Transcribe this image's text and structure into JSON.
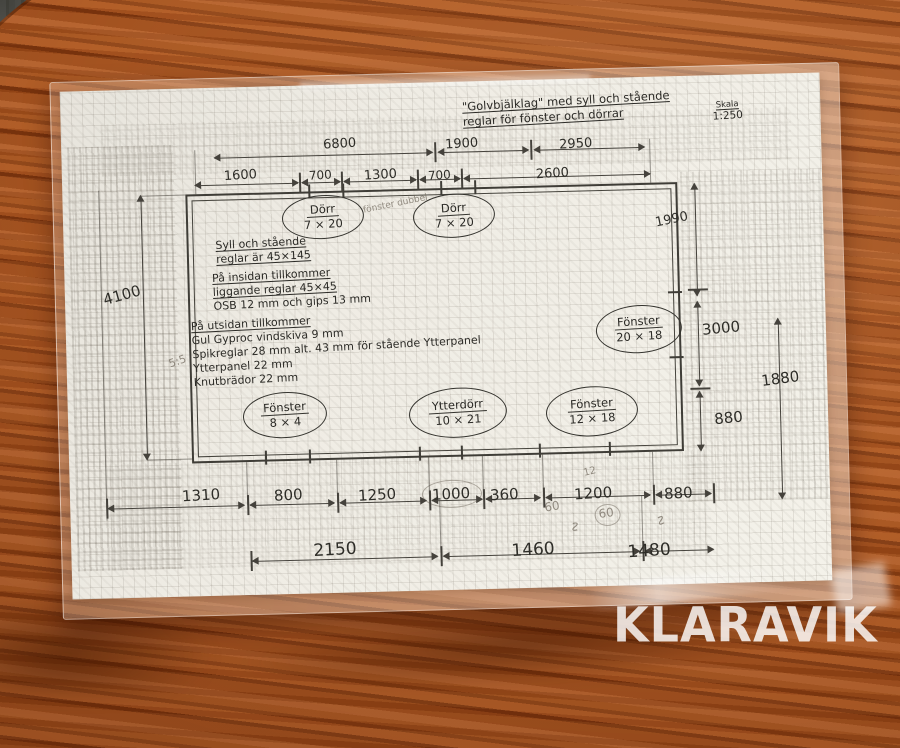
{
  "scene": {
    "watermark": "KLARAVIK"
  },
  "drawing": {
    "title_line1": "\"Golvbjälklag\" med syll och stående",
    "title_line2": "reglar för fönster och dörrar",
    "scale_label": "Skala",
    "scale_value": "1:250",
    "notes_sill": [
      "Syll och stående",
      "reglar är 45×145"
    ],
    "notes_inside": [
      "På insidan tillkommer",
      "liggande reglar 45×45",
      "OSB 12 mm och gips 13 mm"
    ],
    "notes_outside": [
      "På utsidan tillkommer",
      "Gul Gyproc vindskiva 9 mm",
      "Spikreglar 28 mm alt. 43 mm för stående Ytterpanel",
      "Ytterpanel 22 mm",
      "Knutbrädor 22 mm"
    ],
    "openings": [
      {
        "label": "Dörr",
        "size": "7 × 20"
      },
      {
        "label": "Dörr",
        "size": "7 × 20"
      },
      {
        "label": "Fönster",
        "size": "20 × 18"
      },
      {
        "label": "Fönster",
        "size": "8 × 4"
      },
      {
        "label": "Ytterdörr",
        "size": "10 × 21"
      },
      {
        "label": "Fönster",
        "size": "12 × 18"
      }
    ],
    "dims": {
      "top_row1": [
        "6800",
        "1900",
        "2950"
      ],
      "top_row2": [
        "1600",
        "700",
        "1300",
        "700",
        "2600"
      ],
      "left": "4100",
      "right_inner": [
        "1990",
        "3000",
        "880"
      ],
      "right_outer": "1880",
      "bottom_row1": [
        "1310",
        "800",
        "1250",
        "1000",
        "360",
        "1200",
        "880"
      ],
      "bottom_row2": [
        "2150",
        "1460",
        "1480"
      ]
    },
    "pencil": {
      "door_note": "fönster dubbel",
      "side_note": "5:5",
      "mark_12": "12",
      "mark_60a": "60",
      "mark_60b": "60",
      "squiggle": "∿"
    }
  }
}
